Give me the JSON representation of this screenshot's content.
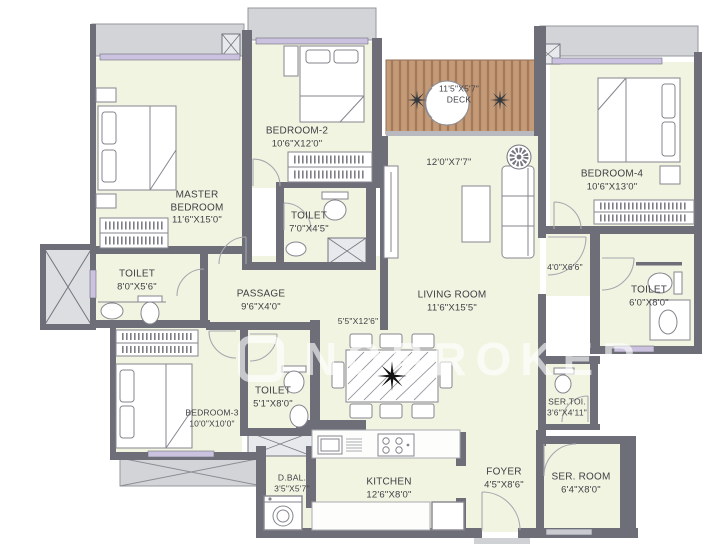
{
  "title": "Apartment floor plan",
  "watermark": {
    "text": "NOBROKER"
  },
  "colors": {
    "wall": "#6d6e78",
    "floor": "#f2f4e2",
    "deck": "#c59b77",
    "deck_stripe": "#9c7659",
    "ledge": "#d2d4d8",
    "window": "#cbc2df",
    "furniture_line": "#85868e"
  },
  "rooms": [
    {
      "id": "master-bedroom",
      "name": "MASTER BEDROOM",
      "dims": "11'6\"X15'0\""
    },
    {
      "id": "bedroom-2",
      "name": "BEDROOM-2",
      "dims": "10'6\"X12'0\""
    },
    {
      "id": "toilet-bedroom2",
      "name": "TOILET",
      "dims": "7'0\"X4'5\""
    },
    {
      "id": "deck",
      "name": "DECK",
      "dims": "11'5\"X5'7\""
    },
    {
      "id": "living-upper",
      "name": "",
      "dims": "12'0\"X7'7\""
    },
    {
      "id": "bedroom-4",
      "name": "BEDROOM-4",
      "dims": "10'6\"X13'0\""
    },
    {
      "id": "passage-right",
      "name": "",
      "dims": "4'0\"X6'6\""
    },
    {
      "id": "toilet-bedroom4",
      "name": "TOILET",
      "dims": "6'0\"X8'0\""
    },
    {
      "id": "living-room",
      "name": "LIVING ROOM",
      "dims": "11'6\"X15'5\""
    },
    {
      "id": "dining",
      "name": "",
      "dims": "5'5\"X12'6\""
    },
    {
      "id": "passage",
      "name": "PASSAGE",
      "dims": "9'6\"X4'0\""
    },
    {
      "id": "toilet-master",
      "name": "TOILET",
      "dims": "8'0\"X5'6\""
    },
    {
      "id": "bedroom-3",
      "name": "BEDROOM-3",
      "dims": "10'0\"X10'0\""
    },
    {
      "id": "toilet-bedroom3",
      "name": "TOILET",
      "dims": "5'1\"X8'0\""
    },
    {
      "id": "d-bal",
      "name": "D.BAL.",
      "dims": "3'5\"X5'7\""
    },
    {
      "id": "kitchen",
      "name": "KITCHEN",
      "dims": "12'6\"X8'0\""
    },
    {
      "id": "foyer",
      "name": "FOYER",
      "dims": "4'5\"X8'6\""
    },
    {
      "id": "ser-toi",
      "name": "SER.TOI.",
      "dims": "3'6\"X4'11\""
    },
    {
      "id": "ser-room",
      "name": "SER. ROOM",
      "dims": "6'4\"X8'0\""
    }
  ]
}
